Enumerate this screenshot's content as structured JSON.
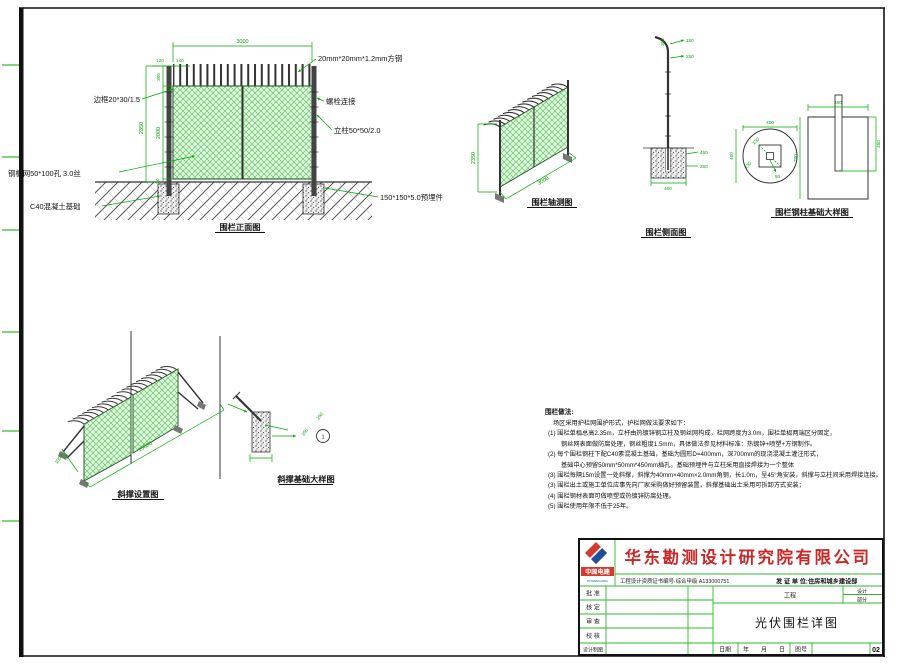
{
  "colors": {
    "dim_green": "#00a800",
    "table_green": "#2db82d",
    "company_red": "#c62828",
    "mesh_fill": "#dcf5dc",
    "logo_red": "#d6382e",
    "logo_blue": "#1d4f9c"
  },
  "front_view": {
    "caption": "围栏正面图",
    "labels": {
      "frame": "边框20*30/1.5",
      "mesh": "钢板网50*100孔 3.0丝",
      "foundation": "C40混凝土基础",
      "square_steel": "20mm*20mm*1.2mm方钢",
      "bolt": "螺栓连接",
      "post": "立柱50*50/2.0",
      "embed": "150*150*5.0预埋件"
    },
    "dims": {
      "w": "3000",
      "d120": "120",
      "d140": "140",
      "d300": "300",
      "h_total": "2350",
      "h_mesh": "2000",
      "d50": "50"
    }
  },
  "axon_view": {
    "caption": "围栏轴测图",
    "dims": {
      "h": "2350",
      "w": "3000"
    }
  },
  "side_view": {
    "caption": "围栏侧面图",
    "dims": {
      "top": "300",
      "r1": "150",
      "r2": "250",
      "e1": "450",
      "e2": "250",
      "w": "400"
    }
  },
  "column_foundation": {
    "caption": "围栏钢柱基础大样图",
    "plan": {
      "w": "400",
      "h": "400",
      "s1": "150",
      "s2": "150",
      "hole": "50"
    },
    "section": {
      "w": "400",
      "d": "700",
      "embed": "450"
    }
  },
  "brace_view": {
    "caption": "斜撑设置图",
    "dims": {
      "len": "15000",
      "off": "1000"
    }
  },
  "brace_foundation": {
    "caption": "斜撑基础大样图",
    "dims": {
      "a": "250",
      "b": "250"
    },
    "bubble": "1"
  },
  "notes": {
    "heading": "围栏做法:",
    "lines": [
      "场区采用护栏网围护形式，护栏网做法要求如下：",
      "(1) 围栏单榀总高2.35m，立杆由热镀锌钢立柱及钢丝网构成，栏网跨度为3.0m，围栏单榀两端区分固定，",
      "钢丝网表面做防腐处理，钢丝粗度1.5mm，具体做法参见材料标准：热镀锌+喷塑+方钢制作。",
      "(2) 每个围栏钢柱下配C40素混凝土基础，基础为圆形D=400mm，深700mm的现浇混凝土灌注形式，",
      "基础中心预留50mm*50mm*450mm插孔。基础预埋件与立柱采用直接焊接为一个整体",
      "(3) 围栏每隔15m设置一处斜撑，斜撑为40mm×40mm×2.0mm角钢，长1.0m，呈45°角安装，斜撑与立柱间采用焊接连接。",
      "(3) 围栏出土或施工单位应事先向厂家采购做好预留装置，斜撑基础出土采用可拆卸方式安装；",
      "(4) 围栏钢材表面可做喷塑或热镀锌防腐处理。",
      "(5) 围栏使用年限不低于25年。"
    ]
  },
  "titleblock": {
    "company": "华东勘测设计研究院有限公司",
    "logo_text": "中国电建",
    "logo_sub": "POWERCHINA",
    "cert": "工程设计资质证书编号·综合甲级 A133000751",
    "issuer": "发 证 单 位:住房和城乡建设部",
    "rows": [
      "批 准",
      "核 定",
      "审 查",
      "校 核",
      "设计制图"
    ],
    "project_label": "工程",
    "design_label": "设计",
    "part_label": "部分",
    "title": "光伏围栏详图",
    "date_label": "日期",
    "ymd": "年　　月　　日",
    "fig_label": "图号",
    "fig_no": "02"
  }
}
